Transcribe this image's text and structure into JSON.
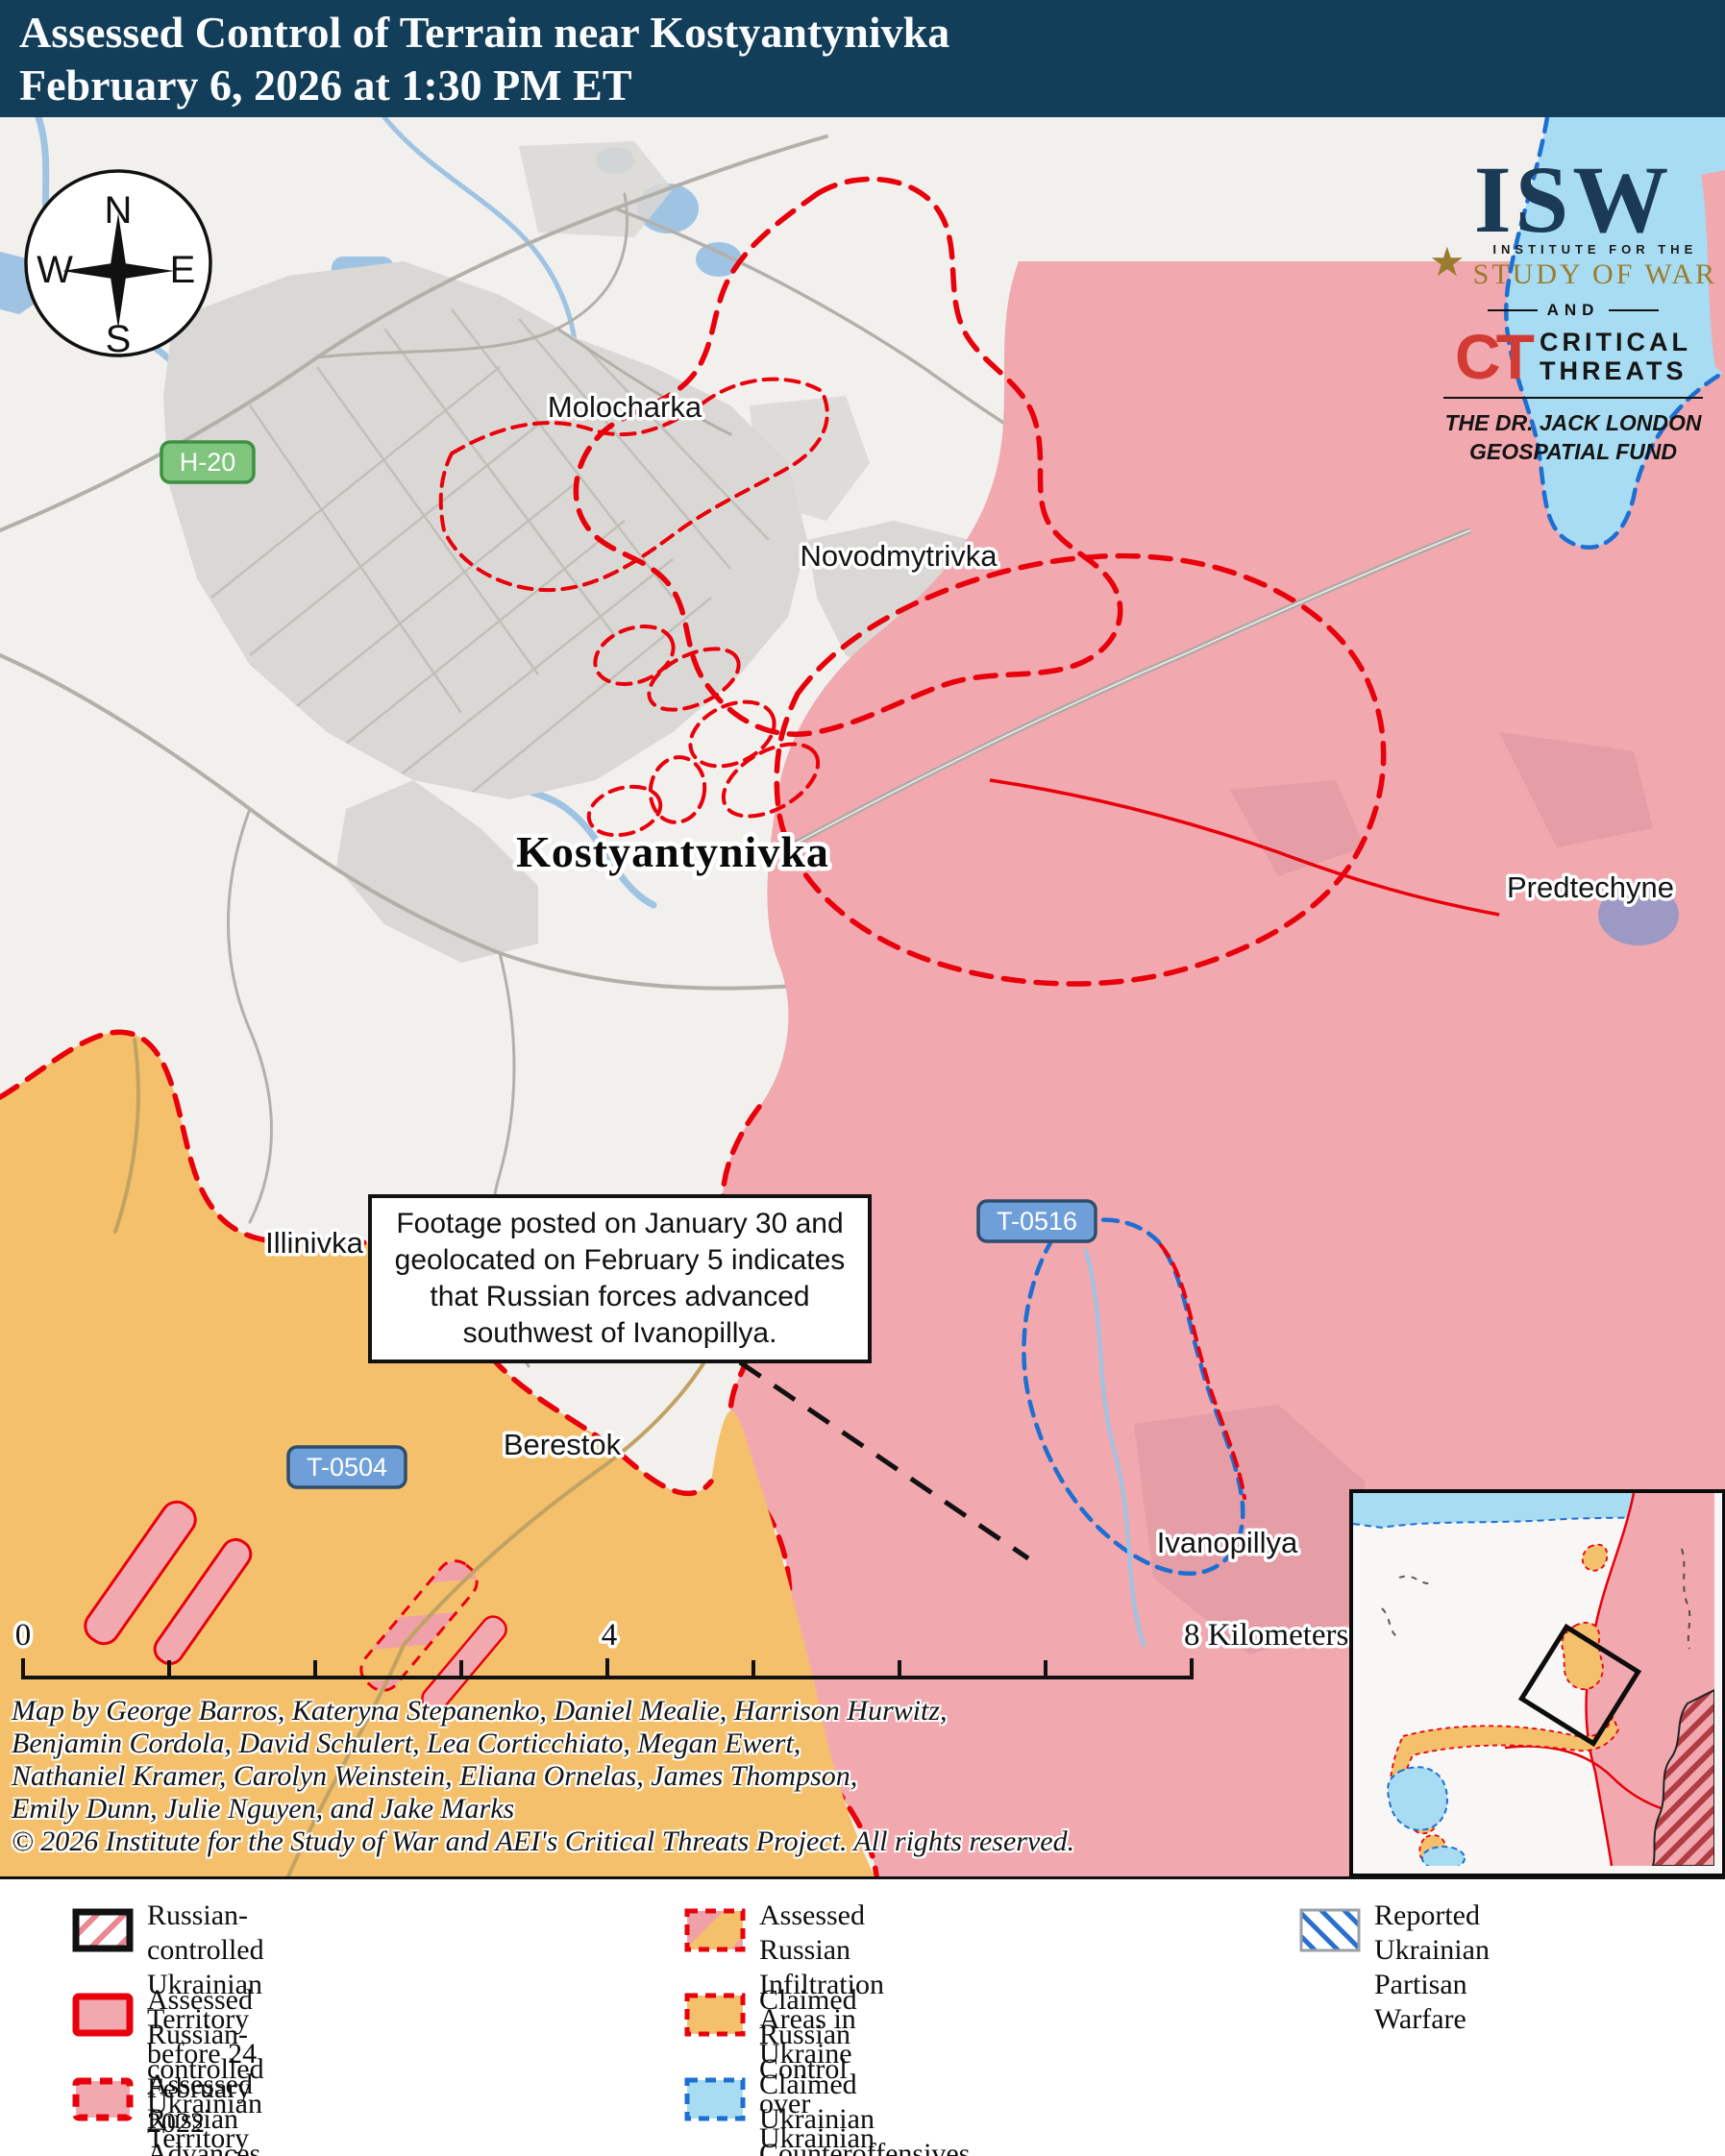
{
  "colors": {
    "titlebar": "#123E5A",
    "red": "#E8000B",
    "orange": "#F4C06C",
    "pink": "#F1A8AF",
    "pinkstripe": "#EFA0A9",
    "lightblue": "#A8DCF2",
    "bluedash": "#1E6FD2",
    "water": "#9FC3E2",
    "urban": "#D9D8D4",
    "road": "#B3B0AB",
    "navy": "#1B3A55",
    "gold": "#9A7C2E",
    "ctred": "#D23B33",
    "greenbadge": "#7FC57D",
    "greenborder": "#3F8F43",
    "bluebadge": "#6F9FD8",
    "bluebadgeborder": "#2E4D6B"
  },
  "title": {
    "line1": "Assessed Control of Terrain near Kostyantynivka",
    "line2": "February 6, 2026 at 1:30 PM ET"
  },
  "logo": {
    "isw": "ISW",
    "star": "★",
    "institute": "INSTITUTE FOR THE",
    "study": "STUDY OF WAR",
    "and": "AND",
    "ct": "CT",
    "critical": "CRITICAL",
    "threats": "THREATS",
    "fund_line1": "THE DR. JACK LONDON",
    "fund_line2": "GEOSPATIAL FUND"
  },
  "compass": {
    "n": "N",
    "e": "E",
    "s": "S",
    "w": "W"
  },
  "map": {
    "labels": {
      "molocharka": "Molocharka",
      "novodmytrivka": "Novodmytrivka",
      "kostyantynivka": "Kostyantynivka",
      "predtechyne": "Predtechyne",
      "illinivka": "Illinivka",
      "berestok": "Berestok",
      "ivanopillya": "Ivanopillya"
    },
    "road_badges": {
      "h20": "H-20",
      "t0516": "T-0516",
      "t0504": "T-0504"
    },
    "annotation": "Footage posted on January 30 and geolocated on February 5 indicates that Russian forces advanced southwest of Ivanopillya.",
    "scale": {
      "zero": "0",
      "four": "4",
      "eight": "8 Kilometers"
    }
  },
  "credits": [
    "Map by George Barros, Kateryna Stepanenko, Daniel Mealie, Harrison Hurwitz,",
    "Benjamin Cordola, David Schulert, Lea Corticchiato, Megan Ewert,",
    "Nathaniel Kramer, Carolyn Weinstein, Eliana Ornelas, James Thompson,",
    "Emily Dunn, Julie Nguyen, and Jake Marks",
    "© 2026 Institute for the Study of War and AEI's Critical Threats Project. All rights reserved."
  ],
  "legend": {
    "items": [
      {
        "label": "Russian-controlled Ukrainian Territory before 24 February 2022"
      },
      {
        "label": "Assessed Russian-controlled Ukrainian Territory"
      },
      {
        "label": "Assessed Russian Advances in Ukraine"
      },
      {
        "label": "Assessed Russian Infiltration Areas in Ukraine"
      },
      {
        "label": "Claimed Russian Control over Ukrainian Territory"
      },
      {
        "label": "Claimed Ukrainian Counteroffensives"
      },
      {
        "label": "Reported Ukrainian Partisan Warfare"
      }
    ]
  }
}
